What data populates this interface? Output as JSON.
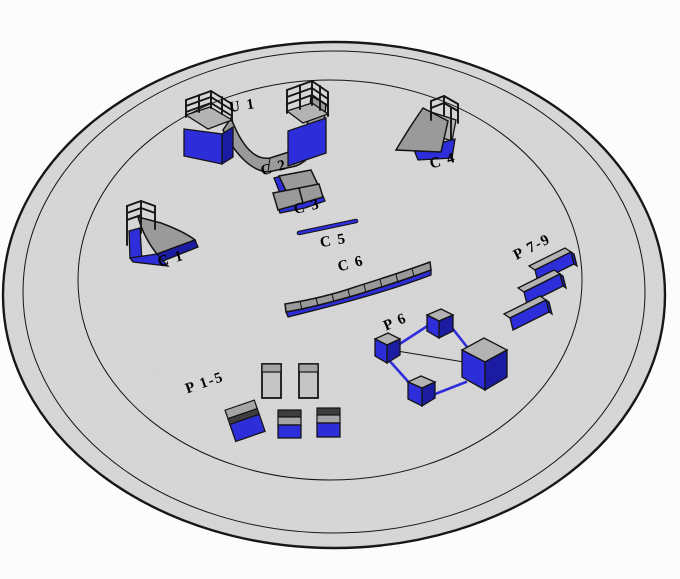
{
  "labels": {
    "u1": "U 1",
    "c1": "C 1",
    "c2": "C 2",
    "c3": "C 3",
    "c4": "C 4",
    "c5": "C 5",
    "c6": "C 6",
    "p15": "P 1-5",
    "p6": "P 6",
    "p79": "P 7-9"
  },
  "colors": {
    "blue": "#2d2dd9",
    "blue-dark": "#1c1ca3",
    "gray-ramp": "#9a9a9a",
    "gray-top": "#b3b3b3",
    "gray-slab": "#c5c5c5",
    "gray-band": "#a5a5a5",
    "dark-band": "#3e3e3e",
    "disk": "#d7d7d7",
    "line": "#141414",
    "label": "#000000",
    "background": "#fcfcfc"
  }
}
